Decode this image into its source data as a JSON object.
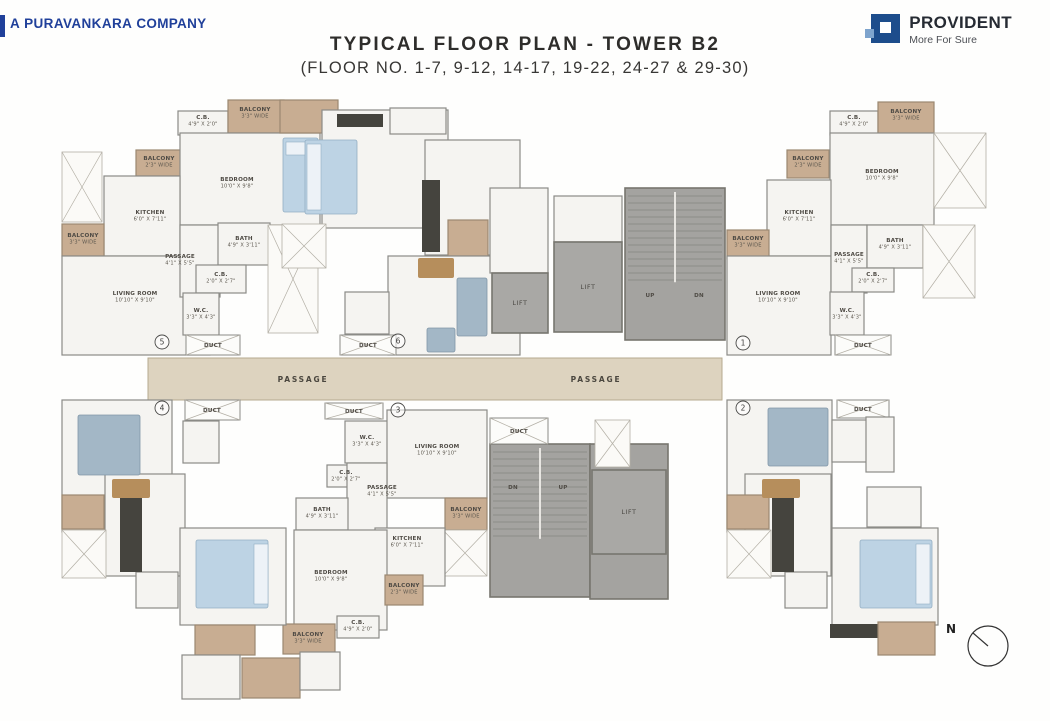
{
  "header": {
    "company_prefix": "A",
    "company_name": "PURAVANKARA",
    "company_suffix": "COMPANY",
    "company_blue": "#20409a",
    "title": "TYPICAL FLOOR PLAN - TOWER B2",
    "subtitle": "(FLOOR NO. 1-7, 9-12, 14-17, 19-22, 24-27 & 29-30)",
    "brand": "PROVIDENT",
    "tagline": "More For Sure",
    "brand_blue": "#1d4d8c"
  },
  "plan": {
    "palette": {
      "room": "#f5f4f1",
      "wall": "#8b8b87",
      "balcony": "#c8ad92",
      "balcony_wall": "#9b8871",
      "corridor": "#ddd3bf",
      "corridor_edge": "#b5a98f",
      "lift": "#a9a8a5",
      "stair": "#a4a3a0",
      "core_wall": "#77766f",
      "duct": "#fcfcfa",
      "void": "#fbfaf7",
      "void_edge": "#b3afa5",
      "bed": "#bdd3e4",
      "bed_edge": "#93aec3",
      "pillow": "#edf2f7",
      "sofa": "#a3b7c6",
      "sofa_edge": "#8196a7",
      "counter": "#45443e",
      "wood": "#b68e5c",
      "text": "#4f4b45"
    },
    "rects": [
      [
        148,
        358,
        574,
        42,
        "corridor"
      ],
      [
        178,
        111,
        50,
        24,
        "room"
      ],
      [
        228,
        100,
        56,
        33,
        "balcony"
      ],
      [
        136,
        150,
        46,
        26,
        "balcony"
      ],
      [
        180,
        133,
        140,
        92,
        "room"
      ],
      [
        104,
        176,
        76,
        80,
        "room"
      ],
      [
        62,
        224,
        42,
        32,
        "balcony"
      ],
      [
        62,
        256,
        148,
        99,
        "room"
      ],
      [
        180,
        225,
        40,
        72,
        "room"
      ],
      [
        218,
        223,
        52,
        42,
        "room"
      ],
      [
        196,
        265,
        50,
        28,
        "room"
      ],
      [
        183,
        293,
        36,
        42,
        "room"
      ],
      [
        186,
        335,
        54,
        20,
        "duct"
      ],
      [
        62,
        152,
        40,
        70,
        "void"
      ],
      [
        268,
        225,
        50,
        108,
        "void"
      ],
      [
        283,
        138,
        35,
        74,
        "bed"
      ],
      [
        286,
        142,
        29,
        13,
        "pillow"
      ],
      [
        280,
        100,
        58,
        33,
        "balcony"
      ],
      [
        322,
        110,
        126,
        118,
        "room"
      ],
      [
        390,
        108,
        56,
        26,
        "room"
      ],
      [
        337,
        114,
        46,
        13,
        "counter"
      ],
      [
        305,
        140,
        52,
        74,
        "bed"
      ],
      [
        307,
        144,
        14,
        66,
        "pillow"
      ],
      [
        425,
        140,
        95,
        115,
        "room"
      ],
      [
        422,
        180,
        18,
        72,
        "counter"
      ],
      [
        448,
        220,
        40,
        36,
        "balcony"
      ],
      [
        388,
        256,
        132,
        99,
        "room"
      ],
      [
        418,
        258,
        36,
        20,
        "wood"
      ],
      [
        457,
        278,
        30,
        58,
        "sofa"
      ],
      [
        427,
        328,
        28,
        24,
        "sofa"
      ],
      [
        345,
        292,
        44,
        42,
        "room"
      ],
      [
        340,
        335,
        56,
        20,
        "duct"
      ],
      [
        282,
        224,
        44,
        44,
        "void"
      ],
      [
        830,
        111,
        48,
        24,
        "room"
      ],
      [
        878,
        102,
        56,
        33,
        "balcony"
      ],
      [
        787,
        150,
        42,
        28,
        "balcony"
      ],
      [
        830,
        133,
        104,
        92,
        "room"
      ],
      [
        767,
        180,
        64,
        76,
        "room"
      ],
      [
        727,
        230,
        42,
        29,
        "balcony"
      ],
      [
        727,
        256,
        104,
        99,
        "room"
      ],
      [
        831,
        225,
        36,
        68,
        "room"
      ],
      [
        867,
        225,
        56,
        43,
        "room"
      ],
      [
        852,
        268,
        42,
        24,
        "room"
      ],
      [
        830,
        292,
        34,
        43,
        "room"
      ],
      [
        835,
        335,
        56,
        20,
        "duct"
      ],
      [
        934,
        133,
        52,
        75,
        "void"
      ],
      [
        923,
        225,
        52,
        73,
        "void"
      ],
      [
        490,
        188,
        58,
        85,
        "room"
      ],
      [
        554,
        196,
        68,
        46,
        "room"
      ],
      [
        492,
        273,
        56,
        60,
        "lift"
      ],
      [
        554,
        242,
        68,
        90,
        "lift"
      ],
      [
        625,
        188,
        100,
        152,
        "stair"
      ],
      [
        490,
        444,
        100,
        153,
        "stair"
      ],
      [
        590,
        444,
        78,
        155,
        "stair2"
      ],
      [
        592,
        470,
        74,
        84,
        "lift"
      ],
      [
        490,
        418,
        58,
        26,
        "duct"
      ],
      [
        595,
        420,
        35,
        47,
        "void"
      ],
      [
        325,
        403,
        58,
        16,
        "duct"
      ],
      [
        345,
        421,
        44,
        42,
        "room"
      ],
      [
        387,
        410,
        100,
        88,
        "room"
      ],
      [
        327,
        465,
        38,
        22,
        "room"
      ],
      [
        347,
        463,
        40,
        72,
        "room"
      ],
      [
        296,
        498,
        52,
        32,
        "room"
      ],
      [
        445,
        498,
        42,
        32,
        "balcony"
      ],
      [
        443,
        530,
        44,
        46,
        "void"
      ],
      [
        375,
        528,
        70,
        58,
        "room"
      ],
      [
        294,
        530,
        93,
        100,
        "room"
      ],
      [
        385,
        575,
        38,
        30,
        "balcony"
      ],
      [
        337,
        616,
        42,
        22,
        "room"
      ],
      [
        283,
        624,
        52,
        30,
        "balcony"
      ],
      [
        185,
        400,
        55,
        20,
        "duct"
      ],
      [
        62,
        400,
        110,
        132,
        "room"
      ],
      [
        183,
        421,
        36,
        42,
        "room"
      ],
      [
        105,
        474,
        80,
        102,
        "room"
      ],
      [
        62,
        495,
        42,
        34,
        "balcony"
      ],
      [
        62,
        530,
        44,
        48,
        "void"
      ],
      [
        136,
        572,
        42,
        36,
        "room"
      ],
      [
        180,
        528,
        106,
        97,
        "room"
      ],
      [
        78,
        415,
        62,
        60,
        "sofa"
      ],
      [
        112,
        479,
        38,
        19,
        "wood"
      ],
      [
        120,
        498,
        22,
        74,
        "counter"
      ],
      [
        196,
        540,
        72,
        68,
        "bed"
      ],
      [
        254,
        544,
        14,
        60,
        "pillow"
      ],
      [
        195,
        625,
        60,
        30,
        "balcony"
      ],
      [
        182,
        655,
        58,
        44,
        "room"
      ],
      [
        242,
        658,
        58,
        40,
        "balcony"
      ],
      [
        300,
        652,
        40,
        38,
        "room"
      ],
      [
        837,
        400,
        52,
        18,
        "duct"
      ],
      [
        727,
        400,
        105,
        132,
        "room"
      ],
      [
        832,
        420,
        36,
        42,
        "room"
      ],
      [
        866,
        417,
        28,
        55,
        "room"
      ],
      [
        745,
        474,
        86,
        102,
        "room"
      ],
      [
        727,
        495,
        42,
        34,
        "balcony"
      ],
      [
        727,
        530,
        44,
        48,
        "void"
      ],
      [
        785,
        572,
        42,
        36,
        "room"
      ],
      [
        832,
        528,
        106,
        97,
        "room"
      ],
      [
        867,
        487,
        54,
        40,
        "room"
      ],
      [
        768,
        408,
        60,
        58,
        "sofa"
      ],
      [
        762,
        479,
        38,
        19,
        "wood"
      ],
      [
        772,
        498,
        22,
        74,
        "counter"
      ],
      [
        860,
        540,
        72,
        68,
        "bed"
      ],
      [
        916,
        544,
        14,
        60,
        "pillow"
      ],
      [
        830,
        624,
        48,
        14,
        "counter"
      ],
      [
        878,
        622,
        57,
        33,
        "balcony"
      ]
    ],
    "labels": [
      {
        "t": "C.B.",
        "d": "4'9\" X 2'0\"",
        "x": 203,
        "y": 119
      },
      {
        "t": "BALCONY",
        "d": "3'3\" WIDE",
        "x": 255,
        "y": 111
      },
      {
        "t": "BALCONY",
        "d": "2'3\" WIDE",
        "x": 159,
        "y": 160
      },
      {
        "t": "BEDROOM",
        "d": "10'0\" X 9'8\"",
        "x": 237,
        "y": 181
      },
      {
        "t": "KITCHEN",
        "d": "6'0\" X 7'11\"",
        "x": 150,
        "y": 214
      },
      {
        "t": "BALCONY",
        "d": "3'3\" WIDE",
        "x": 83,
        "y": 237
      },
      {
        "t": "PASSAGE",
        "d": "4'1\" X 5'5\"",
        "x": 180,
        "y": 258
      },
      {
        "t": "BATH",
        "d": "4'9\" X 3'11\"",
        "x": 244,
        "y": 240
      },
      {
        "t": "C.B.",
        "d": "2'0\" X 2'7\"",
        "x": 221,
        "y": 276
      },
      {
        "t": "LIVING ROOM",
        "d": "10'10\" X 9'10\"",
        "x": 135,
        "y": 295
      },
      {
        "t": "W.C.",
        "d": "3'3\" X 4'3\"",
        "x": 201,
        "y": 312
      },
      {
        "t": "DUCT",
        "x": 213,
        "y": 347
      },
      {
        "t": "DUCT",
        "x": 368,
        "y": 347
      },
      {
        "t": "C.B.",
        "d": "4'9\" X 2'0\"",
        "x": 854,
        "y": 119
      },
      {
        "t": "BALCONY",
        "d": "3'3\" WIDE",
        "x": 906,
        "y": 113
      },
      {
        "t": "BALCONY",
        "d": "2'3\" WIDE",
        "x": 808,
        "y": 160
      },
      {
        "t": "BEDROOM",
        "d": "10'0\" X 9'8\"",
        "x": 882,
        "y": 173
      },
      {
        "t": "KITCHEN",
        "d": "6'0\" X 7'11\"",
        "x": 799,
        "y": 214
      },
      {
        "t": "BALCONY",
        "d": "3'3\" WIDE",
        "x": 748,
        "y": 240
      },
      {
        "t": "PASSAGE",
        "d": "4'1\" X 5'5\"",
        "x": 849,
        "y": 256
      },
      {
        "t": "BATH",
        "d": "4'9\" X 3'11\"",
        "x": 895,
        "y": 242
      },
      {
        "t": "C.B.",
        "d": "2'0\" X 2'7\"",
        "x": 873,
        "y": 276
      },
      {
        "t": "LIVING ROOM",
        "d": "10'10\" X 9'10\"",
        "x": 778,
        "y": 295
      },
      {
        "t": "W.C.",
        "d": "3'3\" X 4'3\"",
        "x": 847,
        "y": 312
      },
      {
        "t": "DUCT",
        "x": 863,
        "y": 347
      },
      {
        "t": "LIFT",
        "x": 520,
        "y": 305,
        "s": "md"
      },
      {
        "t": "LIFT",
        "x": 588,
        "y": 289,
        "s": "md"
      },
      {
        "t": "UP",
        "x": 650,
        "y": 297
      },
      {
        "t": "DN",
        "x": 699,
        "y": 297
      },
      {
        "t": "PASSAGE",
        "x": 303,
        "y": 382,
        "s": "lg"
      },
      {
        "t": "PASSAGE",
        "x": 596,
        "y": 382,
        "s": "lg"
      },
      {
        "t": "DUCT",
        "x": 519,
        "y": 433
      },
      {
        "t": "DN",
        "x": 513,
        "y": 489
      },
      {
        "t": "UP",
        "x": 563,
        "y": 489
      },
      {
        "t": "LIFT",
        "x": 629,
        "y": 514,
        "s": "md"
      },
      {
        "t": "DUCT",
        "x": 354,
        "y": 413
      },
      {
        "t": "W.C.",
        "d": "3'3\" X 4'3\"",
        "x": 367,
        "y": 439
      },
      {
        "t": "LIVING ROOM",
        "d": "10'10\" X 9'10\"",
        "x": 437,
        "y": 448
      },
      {
        "t": "C.B.",
        "d": "2'0\" X 2'7\"",
        "x": 346,
        "y": 474
      },
      {
        "t": "PASSAGE",
        "d": "4'1\" X 5'5\"",
        "x": 382,
        "y": 489
      },
      {
        "t": "BATH",
        "d": "4'9\" X 3'11\"",
        "x": 322,
        "y": 511
      },
      {
        "t": "BALCONY",
        "d": "3'3\" WIDE",
        "x": 466,
        "y": 511
      },
      {
        "t": "KITCHEN",
        "d": "6'0\" X 7'11\"",
        "x": 407,
        "y": 540
      },
      {
        "t": "BEDROOM",
        "d": "10'0\" X 9'8\"",
        "x": 331,
        "y": 574
      },
      {
        "t": "BALCONY",
        "d": "2'3\" WIDE",
        "x": 404,
        "y": 587
      },
      {
        "t": "C.B.",
        "d": "4'9\" X 2'0\"",
        "x": 358,
        "y": 624
      },
      {
        "t": "BALCONY",
        "d": "3'3\" WIDE",
        "x": 308,
        "y": 636
      },
      {
        "t": "DUCT",
        "x": 212,
        "y": 412
      },
      {
        "t": "DUCT",
        "x": 863,
        "y": 411
      }
    ],
    "units": [
      {
        "n": "1",
        "x": 743,
        "y": 343
      },
      {
        "n": "2",
        "x": 743,
        "y": 408
      },
      {
        "n": "3",
        "x": 398,
        "y": 410
      },
      {
        "n": "4",
        "x": 162,
        "y": 408
      },
      {
        "n": "5",
        "x": 162,
        "y": 342
      },
      {
        "n": "6",
        "x": 398,
        "y": 341
      }
    ],
    "compass": {
      "label": "N",
      "cx": 988,
      "cy": 646,
      "r": 20,
      "nx": 951,
      "ny": 633
    }
  }
}
